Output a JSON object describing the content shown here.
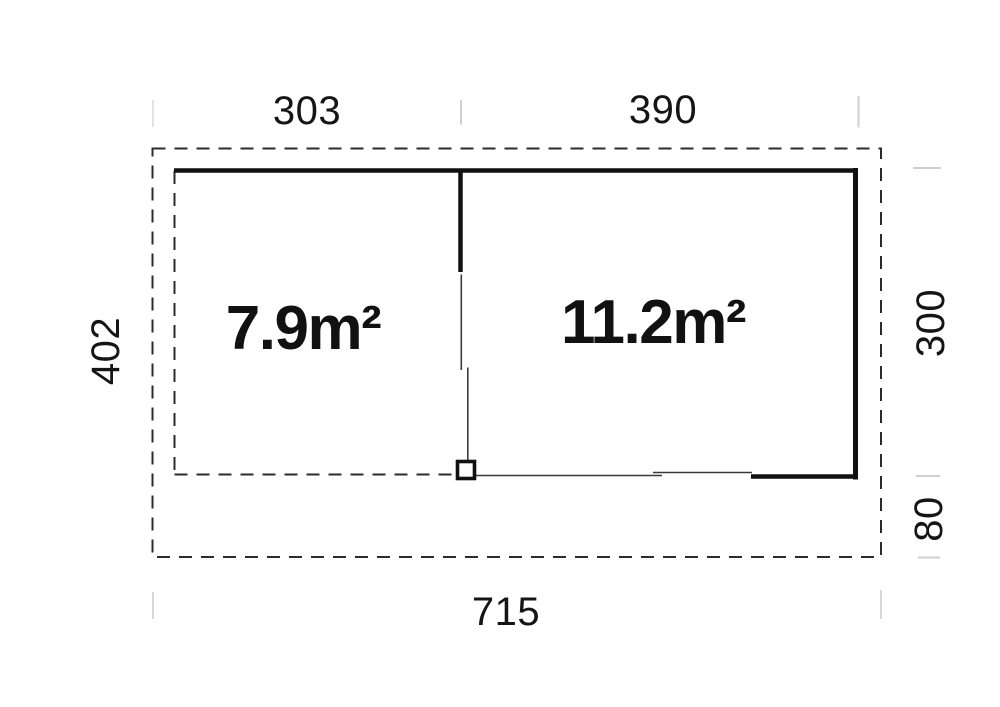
{
  "plan": {
    "rooms": {
      "left": {
        "area": "7.9m²"
      },
      "right": {
        "area": "11.2m²"
      }
    },
    "dims": {
      "top_left": "303",
      "top_right": "390",
      "left": "402",
      "right_upper": "300",
      "right_lower": "80",
      "bottom": "715"
    },
    "colors": {
      "wall": "#111111",
      "dashed_line": "#2b2b2b",
      "thin_line": "#3a3a3a",
      "tick": "#cfcfcf",
      "background": "#ffffff",
      "text": "#151515"
    }
  }
}
